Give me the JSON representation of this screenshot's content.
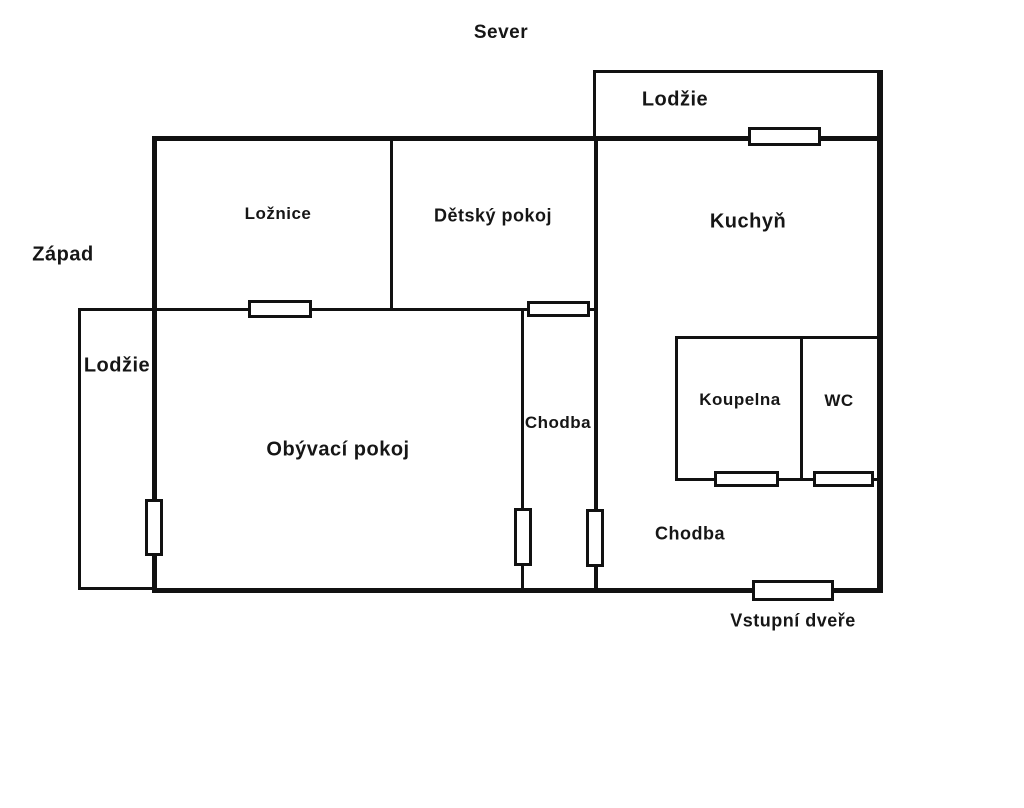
{
  "page": {
    "background": "#ffffff",
    "wall_color": "#111111",
    "opening_fill": "#ffffff",
    "text_color": "#161616"
  },
  "compass": {
    "north_label": "Sever",
    "west_label": "Západ"
  },
  "labels": [
    {
      "id": "sever",
      "text": "Sever",
      "x": 501,
      "y": 33,
      "size": 19
    },
    {
      "id": "zapad",
      "text": "Západ",
      "x": 63,
      "y": 255,
      "size": 20
    },
    {
      "id": "lodzie-sever",
      "text": "Lodžie",
      "x": 675,
      "y": 100,
      "size": 20
    },
    {
      "id": "lodzie-zapad",
      "text": "Lodžie",
      "x": 117,
      "y": 366,
      "size": 20
    },
    {
      "id": "loznice",
      "text": "Ložnice",
      "x": 278,
      "y": 214,
      "size": 17
    },
    {
      "id": "detsky-pokoj",
      "text": "Dětský pokoj",
      "x": 493,
      "y": 216,
      "size": 18
    },
    {
      "id": "kuchyn",
      "text": "Kuchyň",
      "x": 748,
      "y": 222,
      "size": 20
    },
    {
      "id": "obyvaci-pokoj",
      "text": "Obývací pokoj",
      "x": 338,
      "y": 450,
      "size": 20
    },
    {
      "id": "chodba-svisla",
      "text": "Chodba",
      "x": 558,
      "y": 423,
      "size": 17
    },
    {
      "id": "koupelna",
      "text": "Koupelna",
      "x": 740,
      "y": 400,
      "size": 17
    },
    {
      "id": "wc",
      "text": "WC",
      "x": 839,
      "y": 401,
      "size": 17
    },
    {
      "id": "chodba-dolni",
      "text": "Chodba",
      "x": 690,
      "y": 534,
      "size": 18
    },
    {
      "id": "vstupni-dvere",
      "text": "Vstupní dveře",
      "x": 793,
      "y": 621,
      "size": 18
    }
  ],
  "walls": [
    {
      "id": "obvod-top",
      "x": 152,
      "y": 136,
      "w": 731,
      "h": 5
    },
    {
      "id": "obvod-left",
      "x": 152,
      "y": 136,
      "w": 5,
      "h": 457
    },
    {
      "id": "obvod-right",
      "x": 877,
      "y": 136,
      "w": 6,
      "h": 457
    },
    {
      "id": "obvod-bottom",
      "x": 152,
      "y": 588,
      "w": 731,
      "h": 5
    },
    {
      "id": "lodzie-sever-top",
      "x": 593,
      "y": 70,
      "w": 289,
      "h": 3
    },
    {
      "id": "lodzie-sever-left",
      "x": 593,
      "y": 70,
      "w": 3,
      "h": 66
    },
    {
      "id": "lodzie-sever-right",
      "x": 877,
      "y": 70,
      "w": 6,
      "h": 66
    },
    {
      "id": "kuchyn-left",
      "x": 594,
      "y": 141,
      "w": 4,
      "h": 447
    },
    {
      "id": "loznice-detsky-del",
      "x": 390,
      "y": 141,
      "w": 3,
      "h": 168
    },
    {
      "id": "loznice-bottom",
      "x": 157,
      "y": 308,
      "w": 437,
      "h": 3
    },
    {
      "id": "chodba-left",
      "x": 521,
      "y": 308,
      "w": 3,
      "h": 280
    },
    {
      "id": "koupelna-top",
      "x": 675,
      "y": 336,
      "w": 202,
      "h": 3
    },
    {
      "id": "koupelna-left",
      "x": 675,
      "y": 336,
      "w": 3,
      "h": 145
    },
    {
      "id": "koupelna-wc-del",
      "x": 800,
      "y": 336,
      "w": 3,
      "h": 145
    },
    {
      "id": "koupelna-bottom",
      "x": 675,
      "y": 478,
      "w": 202,
      "h": 3
    },
    {
      "id": "lodzie-zapad-left",
      "x": 78,
      "y": 308,
      "w": 3,
      "h": 282
    },
    {
      "id": "lodzie-zapad-top",
      "x": 78,
      "y": 308,
      "w": 77,
      "h": 3
    },
    {
      "id": "lodzie-zapad-bottom",
      "x": 78,
      "y": 587,
      "w": 77,
      "h": 3
    }
  ],
  "openings": [
    {
      "id": "okno-kuchyn-lodzie",
      "x": 748,
      "y": 127,
      "w": 73,
      "h": 19
    },
    {
      "id": "okno-loznice",
      "x": 248,
      "y": 300,
      "w": 64,
      "h": 18
    },
    {
      "id": "okno-chodba-horni",
      "x": 527,
      "y": 301,
      "w": 63,
      "h": 16
    },
    {
      "id": "okno-obyvaci-lodzie",
      "x": 145,
      "y": 499,
      "w": 18,
      "h": 57
    },
    {
      "id": "dvere-obyvaci-chodba",
      "x": 514,
      "y": 508,
      "w": 18,
      "h": 58
    },
    {
      "id": "dvere-chodba-kuchyn",
      "x": 586,
      "y": 509,
      "w": 18,
      "h": 58
    },
    {
      "id": "dvere-koupelna",
      "x": 714,
      "y": 471,
      "w": 65,
      "h": 16
    },
    {
      "id": "dvere-wc",
      "x": 813,
      "y": 471,
      "w": 61,
      "h": 16
    },
    {
      "id": "vstupni-dvere-otvor",
      "x": 752,
      "y": 580,
      "w": 82,
      "h": 21
    }
  ]
}
